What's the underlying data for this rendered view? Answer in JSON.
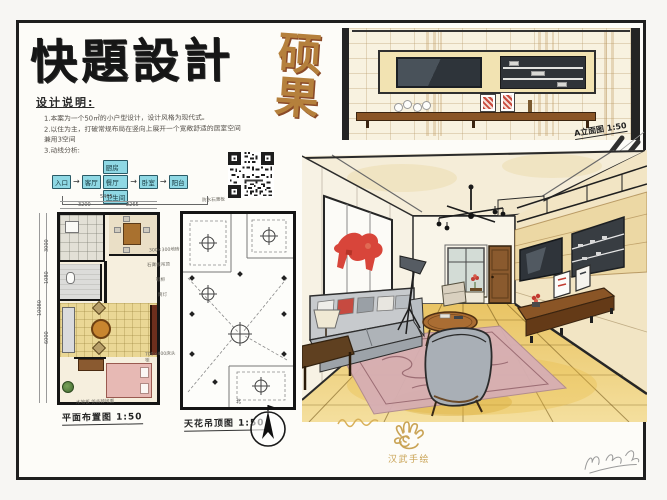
{
  "board": {
    "title": "快題設計",
    "stamp": "硕果",
    "notes": {
      "heading": "设计说明:",
      "line1": "1.本案为一个50㎡的小户型设计，设计风格为现代式。",
      "line2": "2.以住为主，打破常规布局在竖向上展开一个宽敞舒适的居室空间",
      "line3": "兼用3空间",
      "line4": "3.动线分析:"
    },
    "flow": {
      "arrow": "→",
      "n1": "入口",
      "n2": "客厅",
      "b1": "厨房",
      "b2": "餐厅",
      "b3": "卫生间",
      "n3": "卧室",
      "n4": "阳台"
    },
    "floor_plan": {
      "label": "平面布置图 1:50",
      "note": "木地板  仿古砖地面",
      "dim_total_top": "5465",
      "dim_top_1": "3200",
      "dim_top_2": "2265",
      "dim_left_total": "10080",
      "dim_left_1": "3000",
      "dim_left_2": "1080",
      "dim_left_3": "6000",
      "ann_1": "300×300地砖",
      "ann_2": "鞋柜",
      "ann_3": "700×400床头柜"
    },
    "ceiling_plan": {
      "label": "天花吊顶图 1:50",
      "ann_top": "防水石膏板",
      "ann_left1": "石膏板吊顶",
      "ann_left2": "筒灯",
      "ann_right1": "筒灯",
      "ann_right2": "吊灯",
      "compass": "北"
    },
    "elevation": {
      "label": "A立面图 1:50"
    },
    "logo": {
      "text": "汉武手绘"
    },
    "colors": {
      "ink": "#1f1f1f",
      "stamp_tan": "#b5803c",
      "flow_cyan": "#8fd8e4",
      "marker_gold": "#e9c464",
      "logo_gold": "#c9a355",
      "artwork_red": "#d8453a"
    }
  }
}
